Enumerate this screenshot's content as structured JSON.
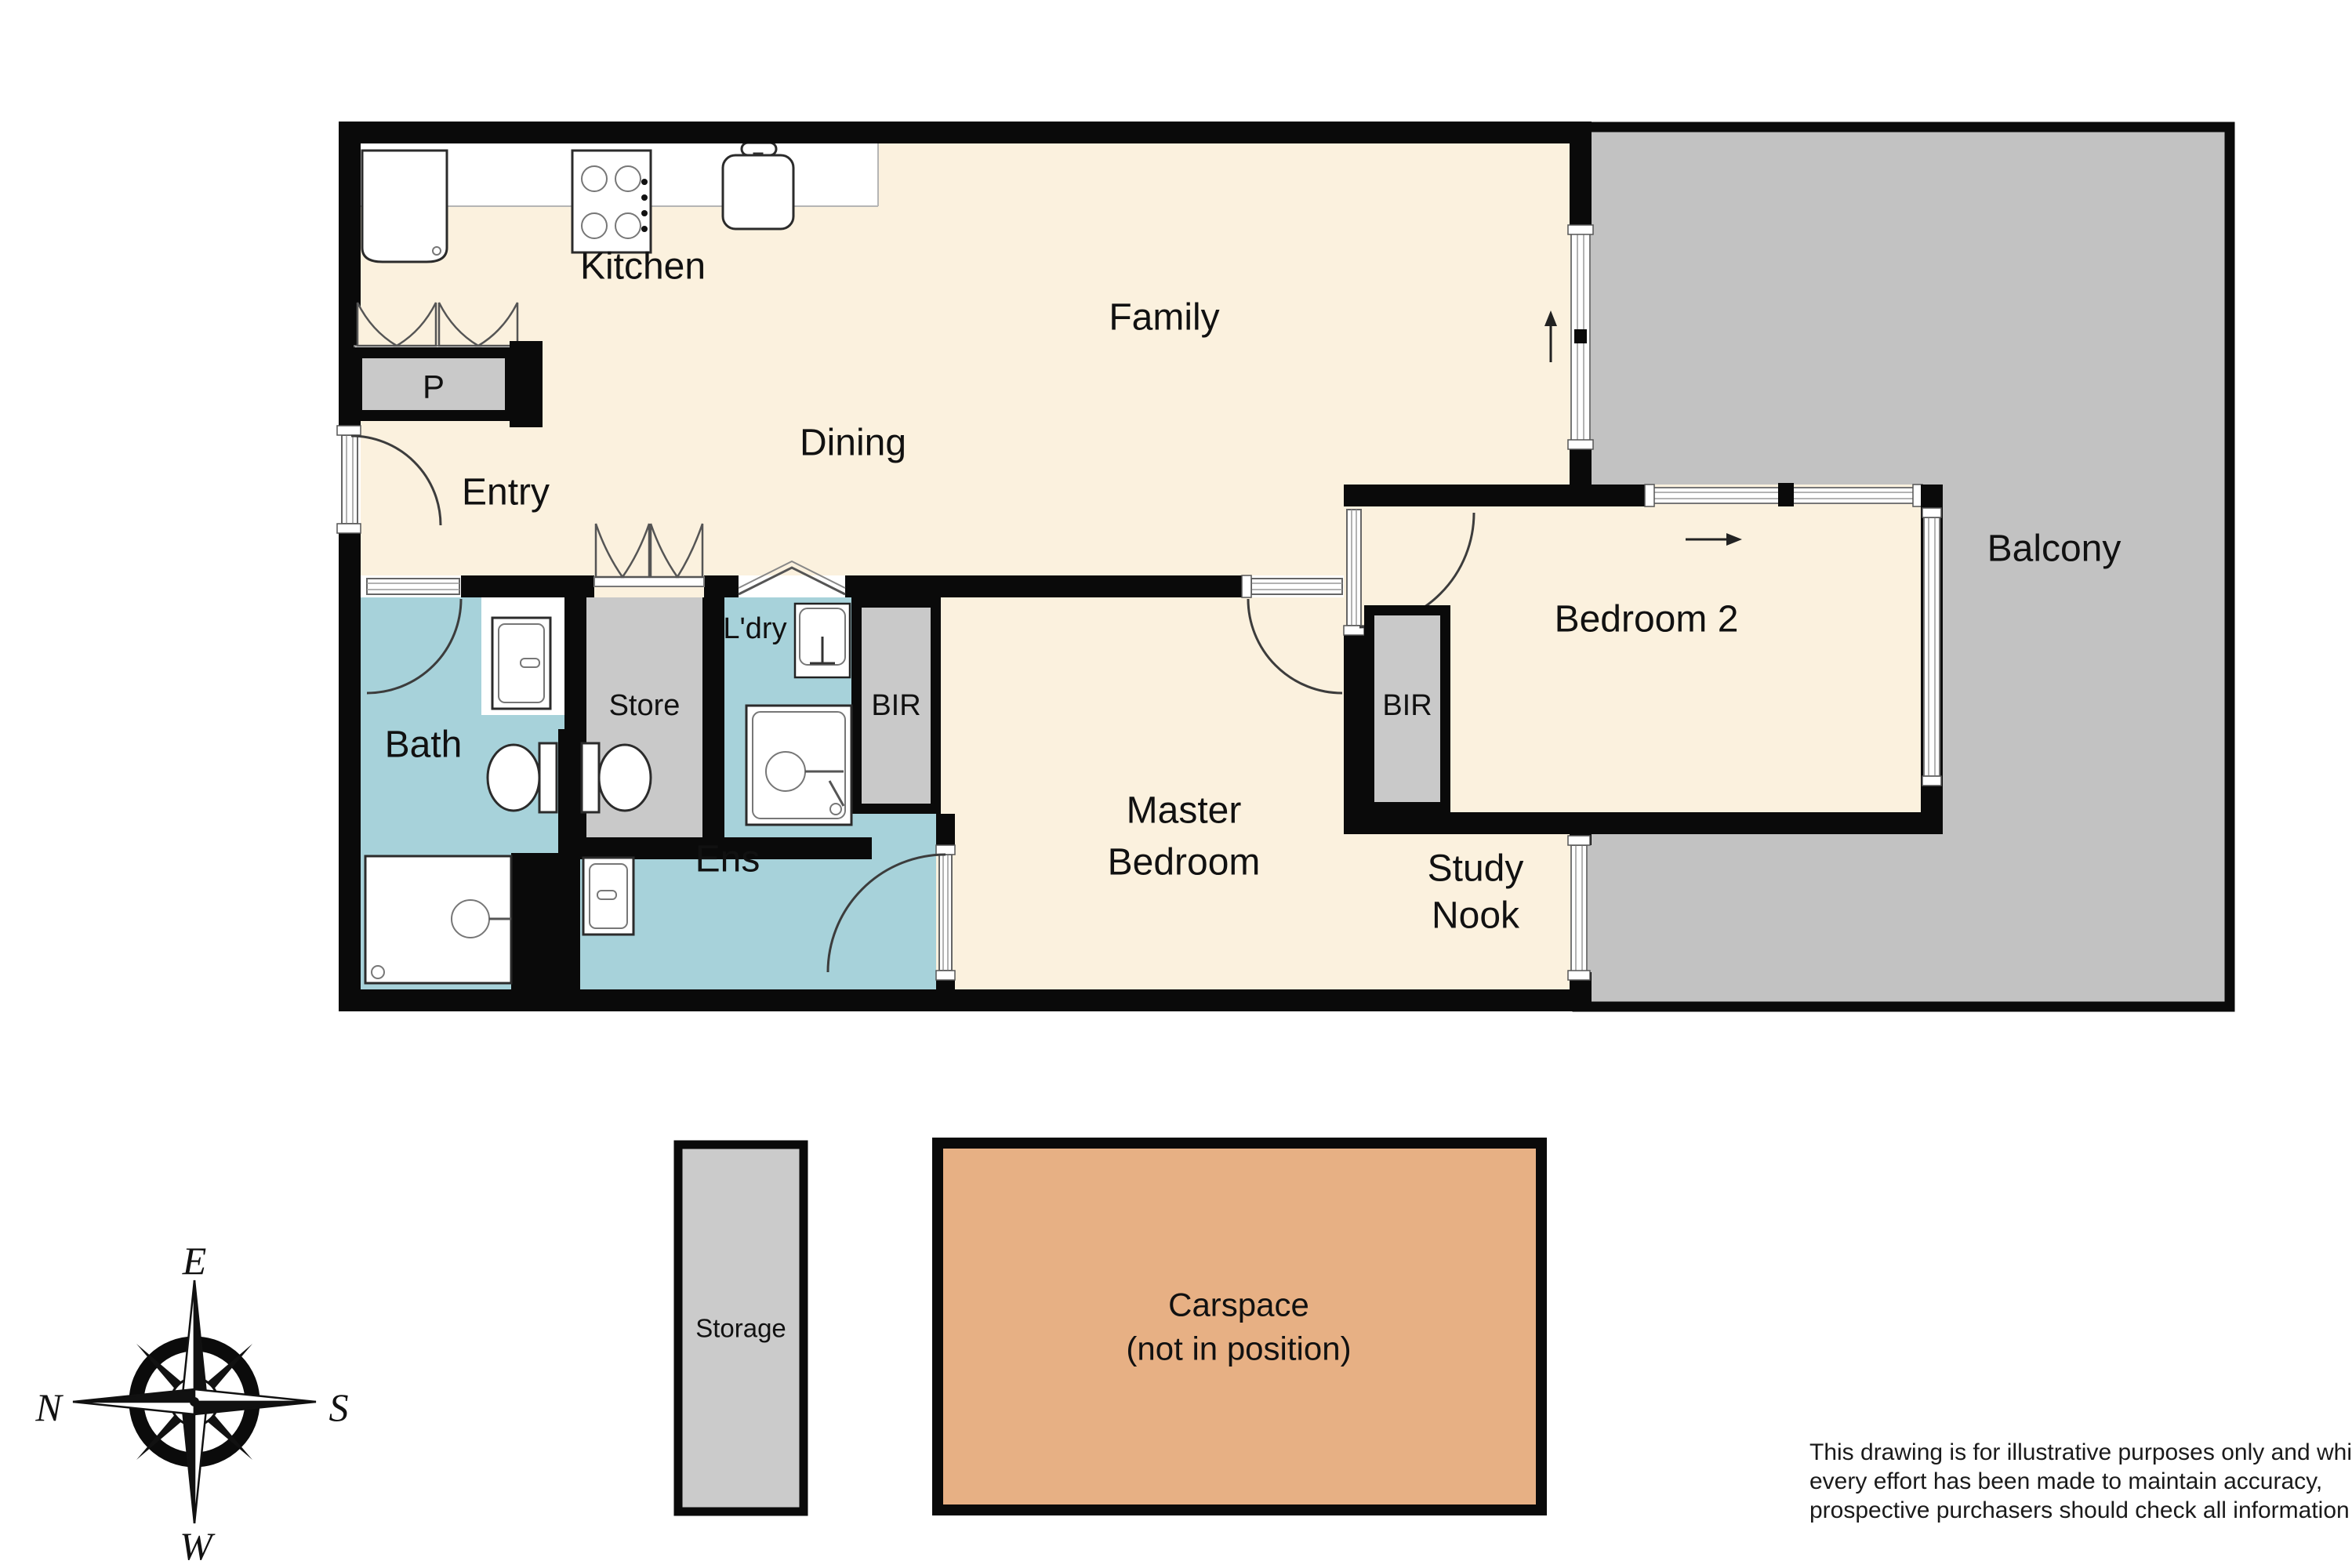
{
  "floorplan": {
    "rooms": {
      "kitchen": "Kitchen",
      "family": "Family",
      "dining": "Dining",
      "entry": "Entry",
      "pantry": "P",
      "store": "Store",
      "laundry": "L'dry",
      "bir_master": "BIR",
      "bir_bedroom2": "BIR",
      "bath": "Bath",
      "ensuite": "Ens",
      "master_line1": "Master",
      "master_line2": "Bedroom",
      "bedroom2": "Bedroom 2",
      "study_line1": "Study",
      "study_line2": "Nook",
      "balcony": "Balcony"
    },
    "annex": {
      "storage": "Storage",
      "carspace_line1": "Carspace",
      "carspace_line2": "(not in position)"
    },
    "compass": {
      "top": "E",
      "left": "N",
      "right": "S",
      "bottom": "W"
    },
    "disclaimer": {
      "line1": "This drawing is for illustrative purposes only and while",
      "line2": "every effort has been made to maintain accuracy,",
      "line3": "prospective purchasers should check all information"
    },
    "colors": {
      "floor_cream": "#fbf1de",
      "wet_teal": "#a7d2da",
      "closet_gray": "#c9c9c9",
      "balcony_gray": "#c2c2c2",
      "carspace_tan": "#e7b084",
      "storage_gray": "#cbcbcb",
      "wall_black": "#0a0a0a"
    }
  }
}
